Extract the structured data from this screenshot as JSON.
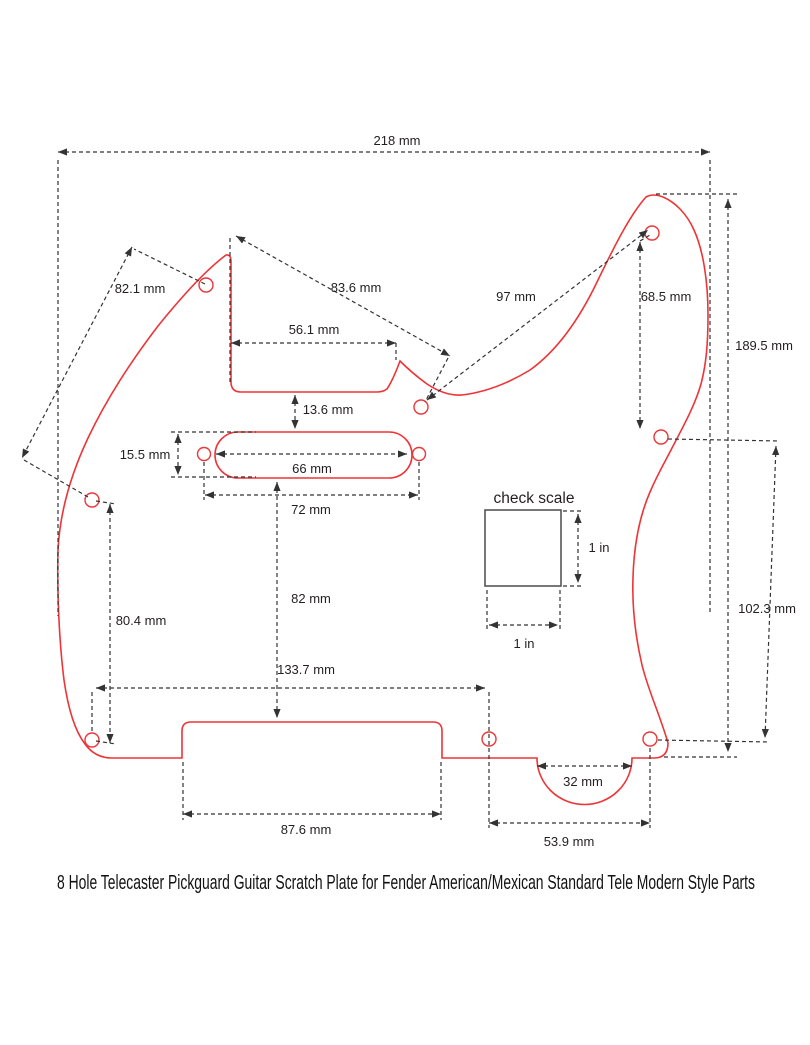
{
  "title": "8 Hole Telecaster Pickguard Guitar Scratch Plate for Fender American/Mexican Standard Tele Modern Style Parts",
  "check_scale": {
    "heading": "check scale",
    "width_label": "1 in",
    "height_label": "1 in"
  },
  "dimensions": {
    "overall_width": "218 mm",
    "upper_left_hole_span": "82.1 mm",
    "neck_to_mid_hole_span": "83.6 mm",
    "mid_to_upper_right_hole_span": "97 mm",
    "upper_right_hole_drop": "68.5 mm",
    "overall_height": "189.5 mm",
    "neck_pocket_width": "56.1 mm",
    "pocket_to_pickup_gap": "13.6 mm",
    "pickup_cutout_height": "15.5 mm",
    "pickup_cutout_width": "66 mm",
    "pickup_screw_span": "72 mm",
    "pickup_to_bridge_gap": "82 mm",
    "left_hole_span": "80.4 mm",
    "right_hole_span": "102.3 mm",
    "bottom_hole_offset": "133.7 mm",
    "bridge_cutout_width": "87.6 mm",
    "arch_width": "32 mm",
    "bottom_right_hole_span": "53.9 mm"
  },
  "colors": {
    "outline": "#ee3437",
    "dimension_lines": "#333333",
    "label_text": "#231f20"
  }
}
